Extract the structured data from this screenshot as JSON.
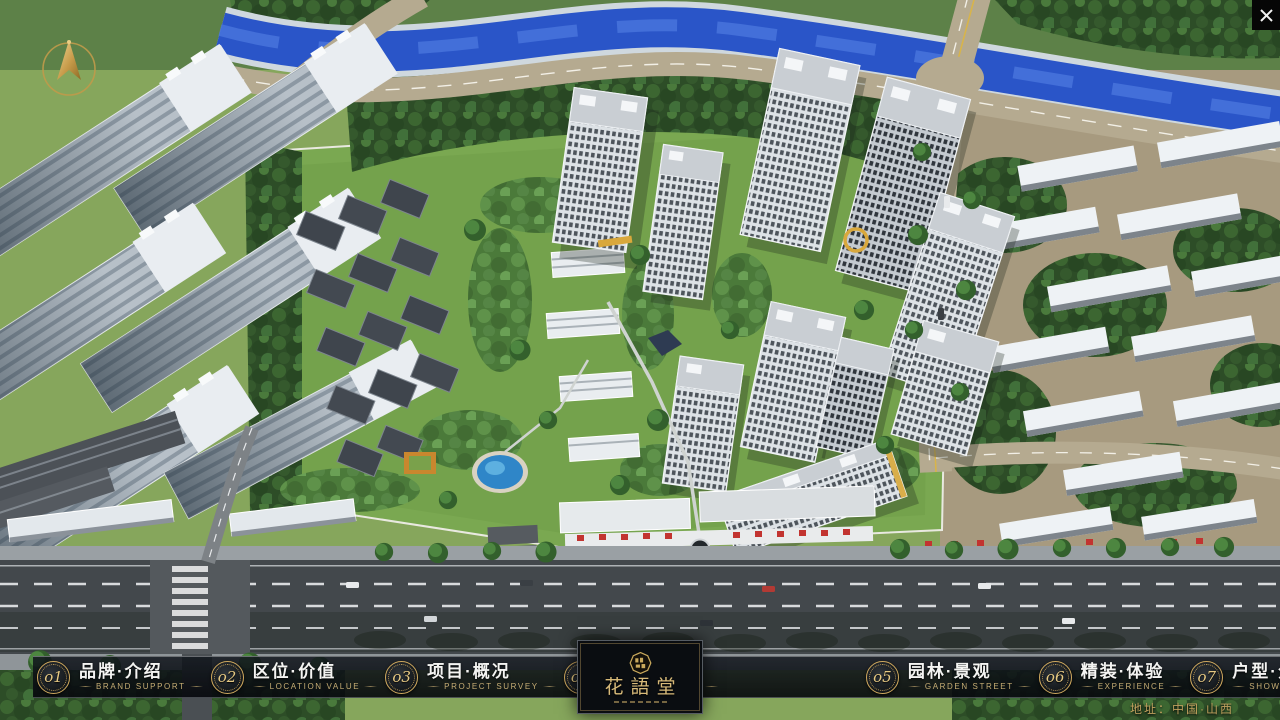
{
  "navbar": {
    "items": [
      {
        "num": "o1",
        "label": "品牌·介绍",
        "sub": "BRAND SUPPORT"
      },
      {
        "num": "o2",
        "label": "区位·价值",
        "sub": "LOCATION VALUE"
      },
      {
        "num": "o3",
        "label": "项目·概况",
        "sub": "PROJECT SURVEY"
      },
      {
        "num": "o4",
        "label": "建筑·鉴赏",
        "sub": "APPRECIATION"
      },
      {
        "num": "o5",
        "label": "园林·景观",
        "sub": "GARDEN STREET"
      },
      {
        "num": "o6",
        "label": "精装·体验",
        "sub": "EXPERIENCE"
      },
      {
        "num": "o7",
        "label": "户型·分布",
        "sub": "SHOW ROOM"
      },
      {
        "num": "o8",
        "label": "一房·一景",
        "sub": "COMMUNITY"
      }
    ]
  },
  "logo": {
    "name": "花語堂"
  },
  "footer": {
    "address": "地址：中国·山西"
  },
  "scene": {
    "type": "aerial-3d-masterplan-rendering",
    "colors": {
      "accent_gold": "#cfa95e",
      "navbar_bg": "#0d1117",
      "river_blue": "#2a55c8",
      "lawn_green": "#7aa851",
      "forest_green": "#2f5029",
      "road_dark": "#43484c",
      "road_tan": "#b5aa90",
      "tower_white": "#e9edf0",
      "label_white": "#f4f4f2",
      "sub_label_tan": "#c6ad74"
    }
  }
}
